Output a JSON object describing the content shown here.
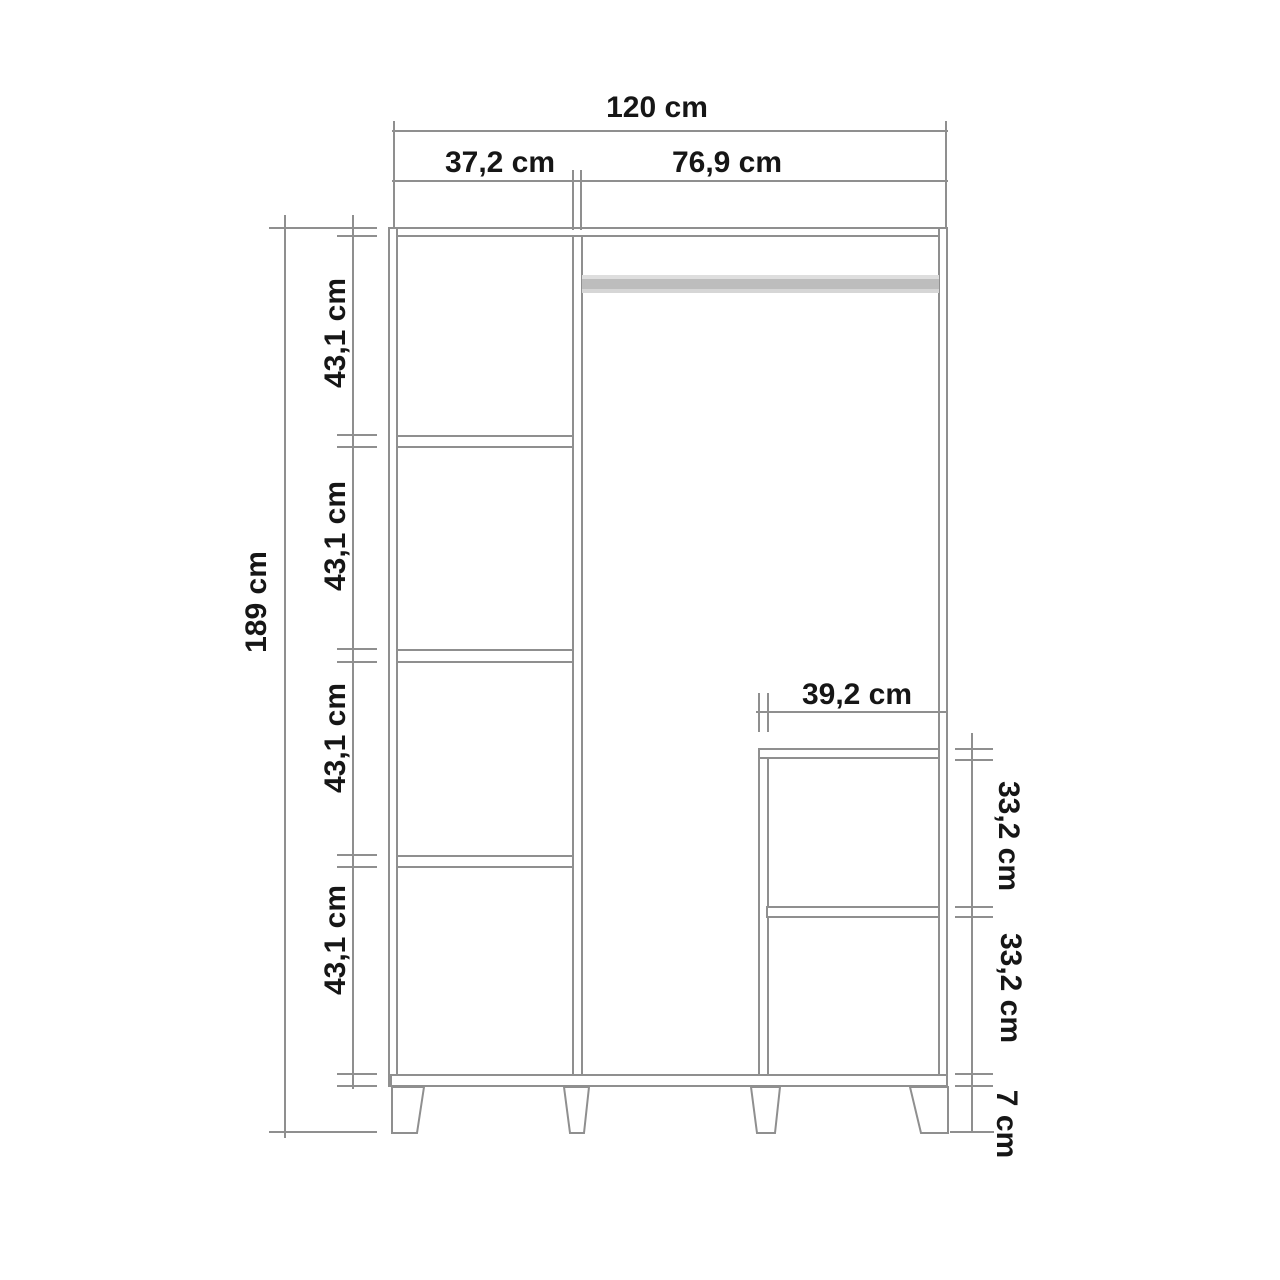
{
  "diagram": {
    "type": "furniture-dimension-drawing",
    "subject": "three-column wardrobe front elevation",
    "colors": {
      "background": "#ffffff",
      "line": "#8f8f8f",
      "text": "#161616",
      "rod_light": "#dedede",
      "rod_dark": "#bdbdbd"
    },
    "dimensions": {
      "total_width": "120 cm",
      "left_column_width": "37,2 cm",
      "main_column_width": "76,9 cm",
      "total_height": "189 cm",
      "left_shelf_heights": [
        "43,1 cm",
        "43,1 cm",
        "43,1 cm",
        "43,1 cm"
      ],
      "inner_shelf_width": "39,2 cm",
      "right_shelf_heights": [
        "33,2 cm",
        "33,2 cm"
      ],
      "leg_height": "7 cm"
    }
  }
}
